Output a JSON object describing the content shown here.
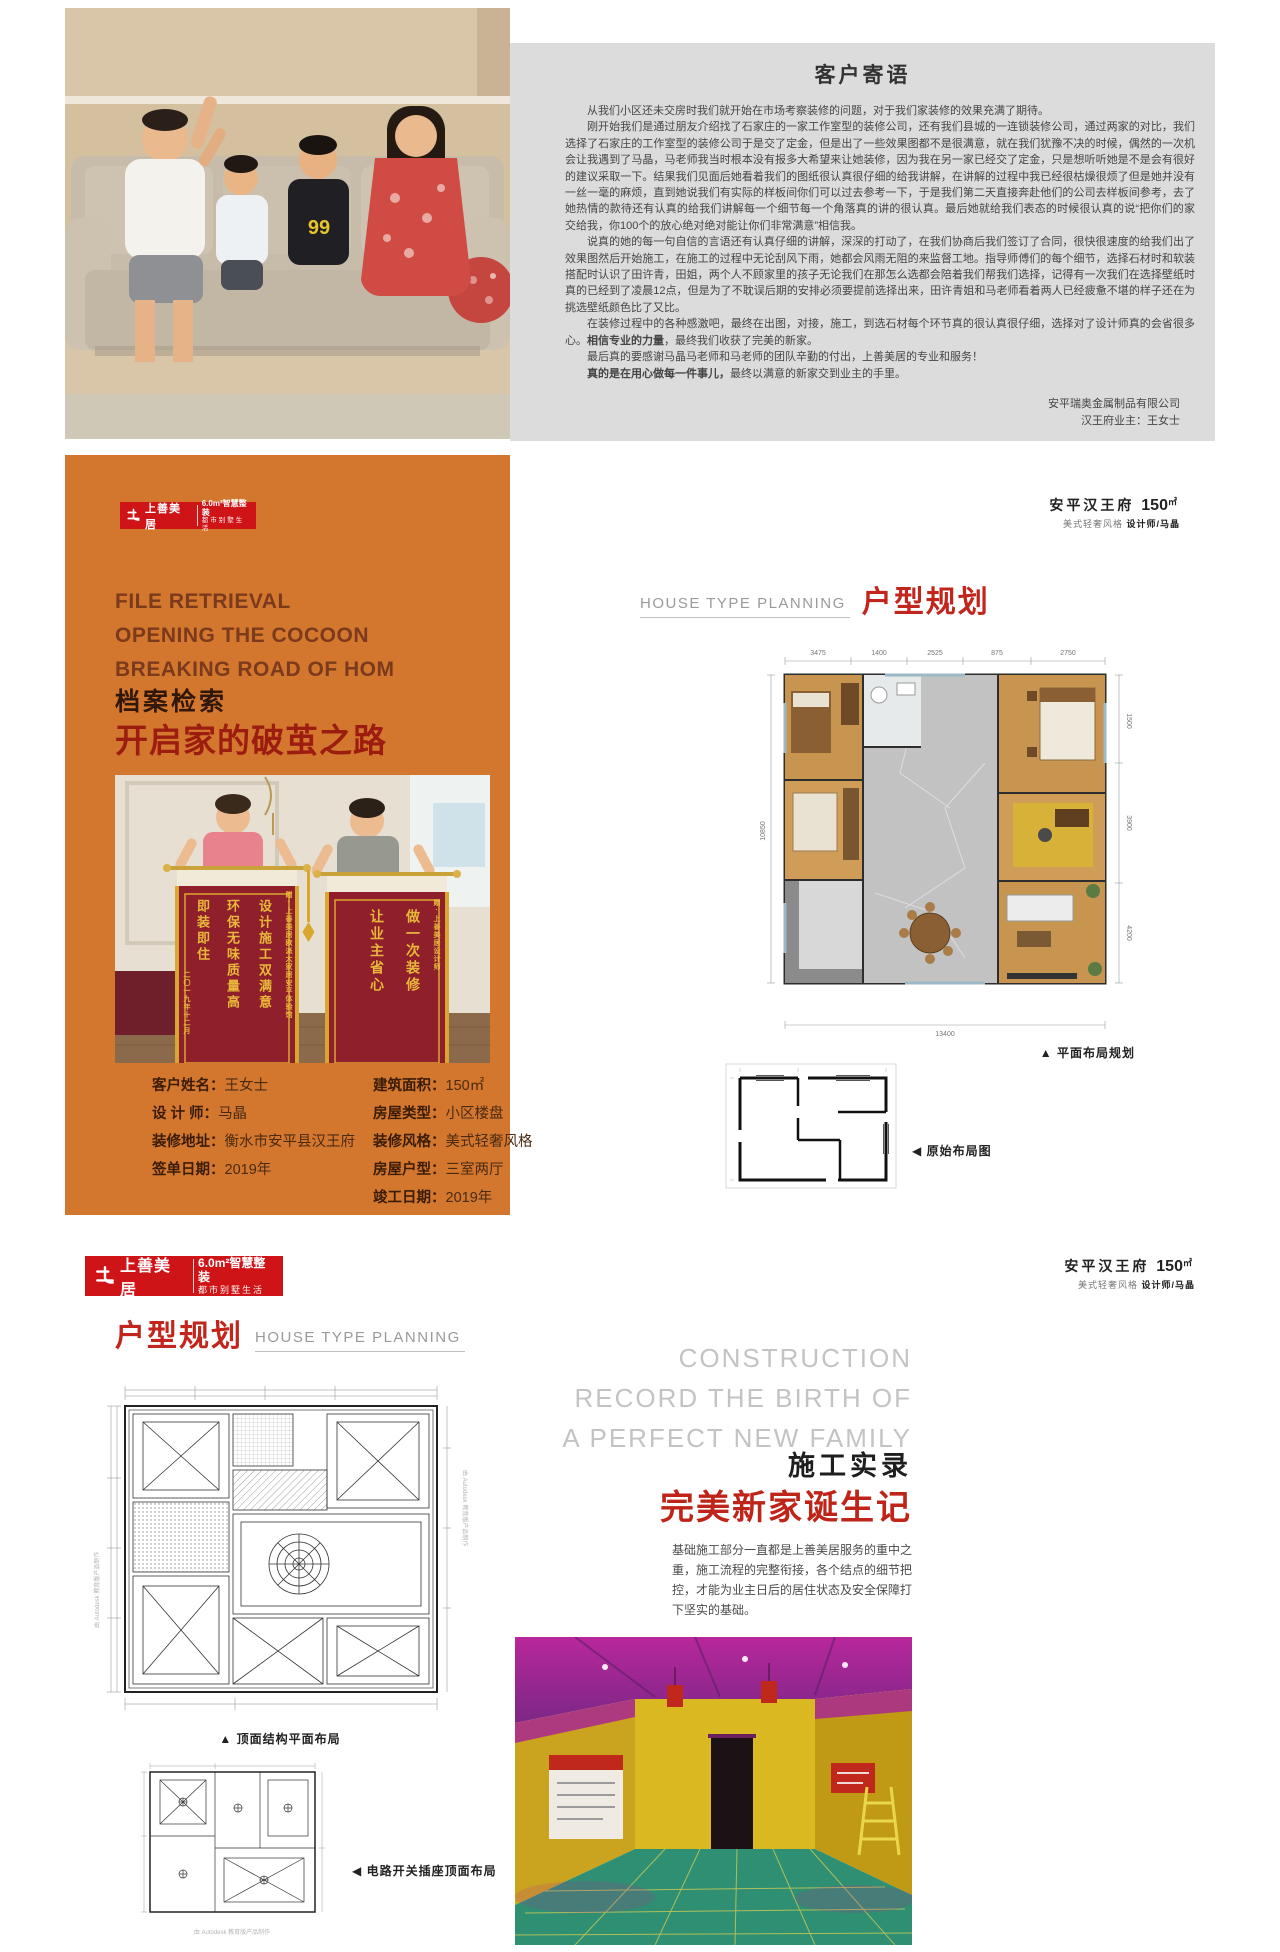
{
  "brand_banner": {
    "logo_text": "上善美居",
    "slogan_line1": "6.0m²智慧整装",
    "slogan_line2": "都市别墅生活"
  },
  "project_header": {
    "name": "安平汉王府",
    "area": "150",
    "area_unit": "㎡",
    "style": "美式轻奢风格",
    "designer": "设计师/马晶"
  },
  "testimonial": {
    "title": "客户寄语",
    "p1": "从我们小区还未交房时我们就开始在市场考察装修的问题，对于我们家装修的效果充满了期待。",
    "p2": "刚开始我们是通过朋友介绍找了石家庄的一家工作室型的装修公司，还有我们县城的一连锁装修公司，通过两家的对比，我们选择了石家庄的工作室型的装修公司于是交了定金，但是出了一些效果图都不是很满意，就在我们犹豫不决的时候，偶然的一次机会让我遇到了马晶，马老师我当时根本没有报多大希望来让她装修，因为我在另一家已经交了定金，只是想听听她是不是会有很好的建议采取一下。结果我们见面后她看着我们的图纸很认真很仔细的给我讲解，在讲解的过程中我已经很枯燥很烦了但是她并没有一丝一毫的麻烦，直到她说我们有实际的样板间你们可以过去参考一下，于是我们第二天直接奔赴他们的公司去样板间参考，去了她热情的款待还有认真的给我们讲解每一个细节每一个角落真的讲的很认真。最后她就给我们表态的时候很认真的说“把你们的家交给我，你100个的放心绝对绝对能让你们非常满意”相信我。",
    "p3": "说真的她的每一句自信的言语还有认真仔细的讲解，深深的打动了，在我们协商后我们签订了合同，很快很速度的给我们出了效果图然后开始施工，在施工的过程中无论刮风下雨，她都会风雨无阻的来监督工地。指导师傅们的每个细节，选择石材时和软装搭配时认识了田许青，田姐，两个人不顾家里的孩子无论我们在那怎么选都会陪着我们帮我们选择，记得有一次我们在选择壁纸时真的已经到了凌晨12点，但是为了不耽误后期的安排必须要提前选择出来，田许青姐和马老师看着两人已经疲惫不堪的样子还在为挑选壁纸颜色比了又比。",
    "p4_pre": "在装修过程中的各种感激吧，最终在出图，对接，施工，到选石材每个环节真的很认真很仔细，选择对了设计师真的会省很多心。",
    "p4_bold": "相信专业的力量",
    "p4_post": "，最终我们收获了完美的新家。",
    "p5": "最后真的要感谢马晶马老师和马老师的团队辛勤的付出，上善美居的专业和服务！",
    "p6_bold": "真的是在用心做每一件事儿，",
    "p6_rest": "最终以满意的新家交到业主的手里。",
    "sign_company": "安平瑞奥金属制品有限公司",
    "sign_owner": "汉王府业主：王女士"
  },
  "family_photo": {
    "shirt_text": "99"
  },
  "archive": {
    "en_line1": "FILE RETRIEVAL",
    "en_line2": "OPENING THE COCOON",
    "en_line3": "BREAKING ROAD OF HOM",
    "cn_small": "档案检索",
    "cn_big": "开启家的破茧之路",
    "banner_photo": {
      "left_col1": "设计施工双满意",
      "left_col2": "环保无味质量高",
      "left_col3": "即装即住",
      "left_side": "赠·上善美居欧派大家居安平体验馆",
      "left_date": "二〇一九年十二月",
      "right_col1": "做一次装修",
      "right_col2": "让业主省心",
      "right_side": "赠·上善美居设计师"
    },
    "info_left": [
      {
        "label": "客户姓名：",
        "value": "王女士"
      },
      {
        "label": "设 计 师：",
        "value": "马晶"
      },
      {
        "label": "装修地址：",
        "value": "衡水市安平县汉王府"
      },
      {
        "label": "签单日期：",
        "value": "2019年"
      }
    ],
    "info_right": [
      {
        "label": "建筑面积：",
        "value": "150㎡"
      },
      {
        "label": "房屋类型：",
        "value": "小区楼盘"
      },
      {
        "label": "装修风格：",
        "value": "美式轻奢风格"
      },
      {
        "label": "房屋户型：",
        "value": "三室两厅"
      },
      {
        "label": "竣工日期：",
        "value": "2019年"
      }
    ]
  },
  "planning": {
    "en": "HOUSE TYPE PLANNING",
    "cn": "户型规划",
    "caption_layout": "▲ 平面布局规划",
    "caption_original": "◀ 原始布局图",
    "dims_top": [
      "3475",
      "1400",
      "2525",
      "875",
      "2750"
    ],
    "dims_right": [
      "1500",
      "3900",
      "4200"
    ],
    "dim_bottom": "13400",
    "dim_left": "10850"
  },
  "cad": {
    "caption_ceiling": "▲ 顶面结构平面布局",
    "caption_electric": "◀ 电路开关插座顶面布局",
    "watermark": "由 Autodesk 教育版产品制作"
  },
  "construction": {
    "en_line1": "CONSTRUCTION",
    "en_line2": "RECORD THE BIRTH OF",
    "en_line3": "A PERFECT NEW FAMILY",
    "cn_title": "施工实录",
    "cn_subtitle": "完美新家诞生记",
    "body": "基础施工部分一直都是上善美居服务的重中之重，施工流程的完整衔接，各个结点的细节把控，才能为业主日后的居住状态及安全保障打下坚实的基础。"
  }
}
